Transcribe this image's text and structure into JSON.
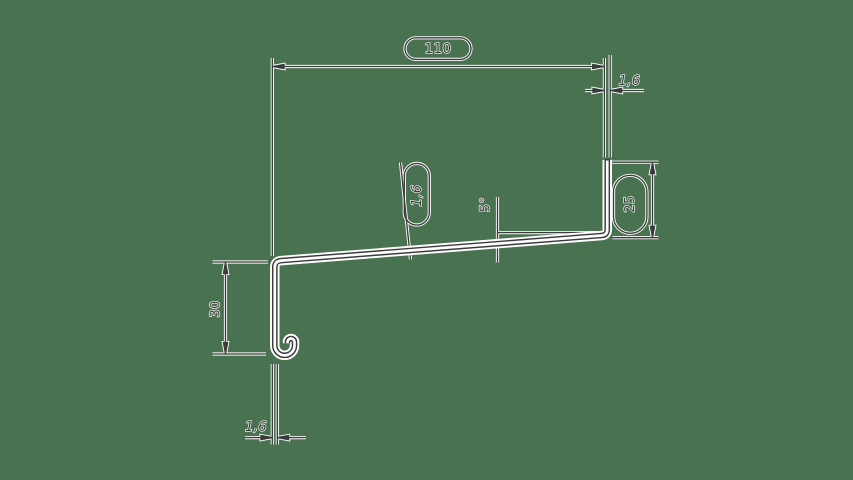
{
  "drawing": {
    "type": "sheet-metal profile cross-section, dimensioned CAD drawing",
    "colors": {
      "background": "#497250",
      "ink": "#3b3b3b",
      "halo": "#fdfdfd"
    },
    "labels": {
      "overall_width": "110",
      "right_flange_thickness": "1,6",
      "right_flange_height": "25",
      "web_thickness": "1,6",
      "web_angle": "5°",
      "left_leg_height": "30",
      "left_leg_thickness": "1,6"
    }
  }
}
